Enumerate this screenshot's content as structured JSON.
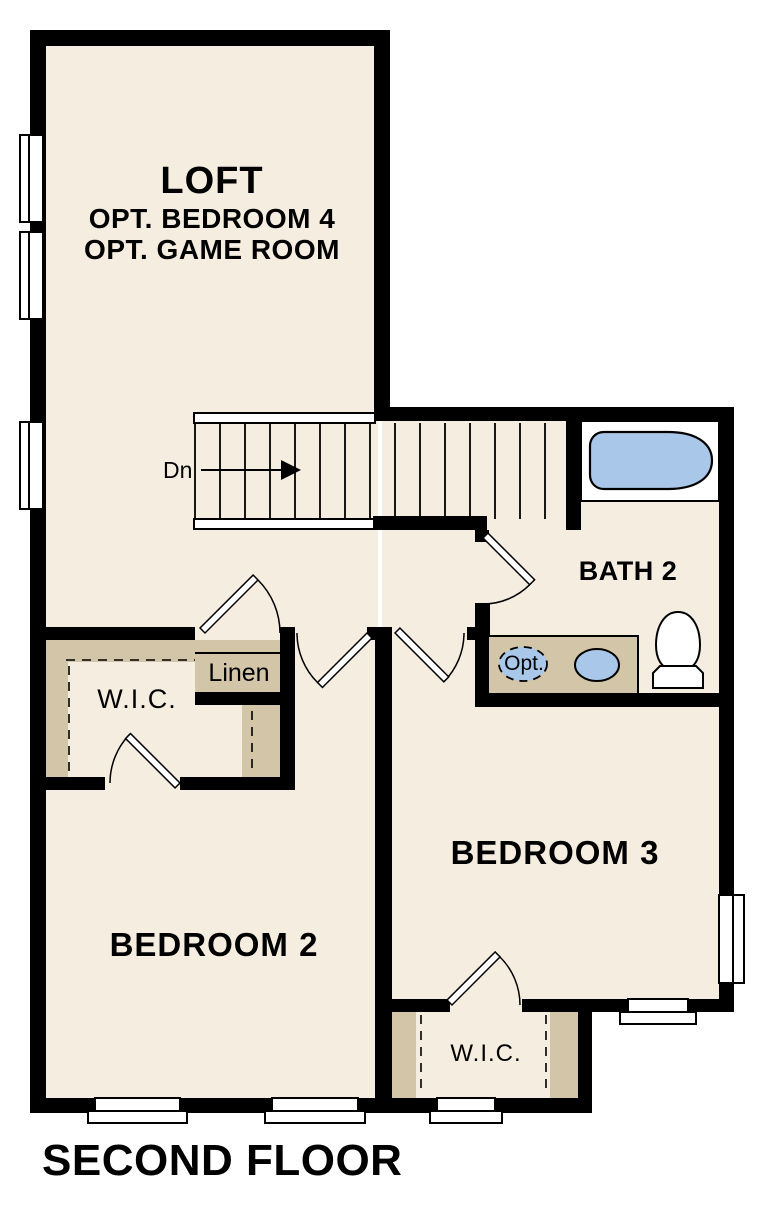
{
  "title": "SECOND FLOOR",
  "rooms": {
    "loft": {
      "name": "LOFT",
      "option_1": "OPT. BEDROOM 4",
      "option_2": "OPT. GAME ROOM"
    },
    "bath_2": {
      "name": "BATH 2"
    },
    "bedroom_2": {
      "name": "BEDROOM 2"
    },
    "bedroom_3": {
      "name": "BEDROOM 3"
    },
    "wic_primary": {
      "name": "W.I.C."
    },
    "wic_bedroom_3": {
      "name": "W.I.C."
    },
    "linen": {
      "name": "Linen"
    }
  },
  "stairs": {
    "direction_label": "Dn"
  },
  "fixtures": {
    "optional_sink_label": "Opt."
  },
  "colors": {
    "wall": "#000000",
    "floor": "#f5eddf",
    "casework": "#d2c5a8",
    "plumbing_blue": "#a9c8e9",
    "background": "#ffffff"
  }
}
